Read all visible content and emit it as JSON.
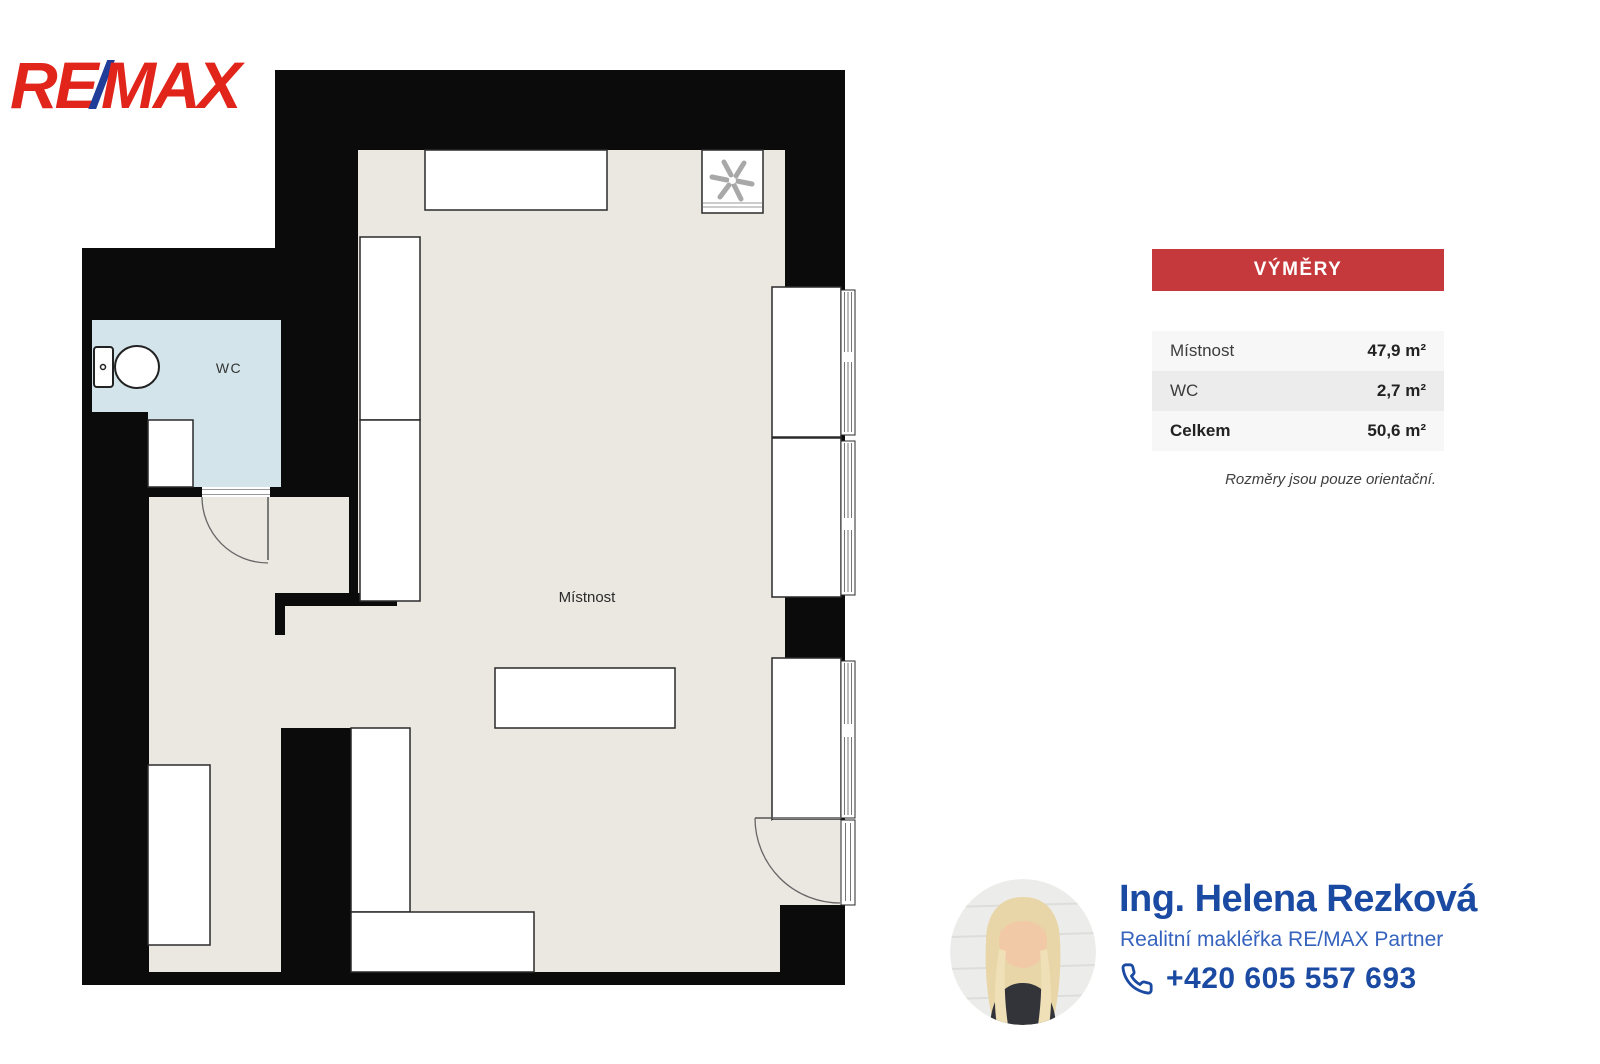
{
  "logo": {
    "re": "RE",
    "slash": "/",
    "max": "MAX",
    "red": "#E1251B",
    "blue": "#1F3D99"
  },
  "floorplan": {
    "room_label": "Místnost",
    "wc_label": "WC",
    "colors": {
      "wall": "#0B0B0B",
      "floor": "#EBE7E1",
      "wc_floor": "#D3E5EA",
      "furniture_fill": "#FFFFFF",
      "furniture_stroke": "#2A2A2A"
    }
  },
  "areas_panel": {
    "title": "VÝMĚRY",
    "header_color": "#C5393C",
    "rows": [
      {
        "label": "Místnost",
        "value": "47,9 m²"
      },
      {
        "label": "WC",
        "value": "2,7 m²"
      },
      {
        "label": "Celkem",
        "value": "50,6 m²"
      }
    ],
    "footnote": "Rozměry jsou pouze orientační."
  },
  "agent": {
    "name": "Ing. Helena Rezková",
    "title": "Realitní makléřka RE/MAX Partner",
    "phone": "+420 605 557 693",
    "name_color": "#1B4AA2",
    "title_color": "#3563BE"
  }
}
